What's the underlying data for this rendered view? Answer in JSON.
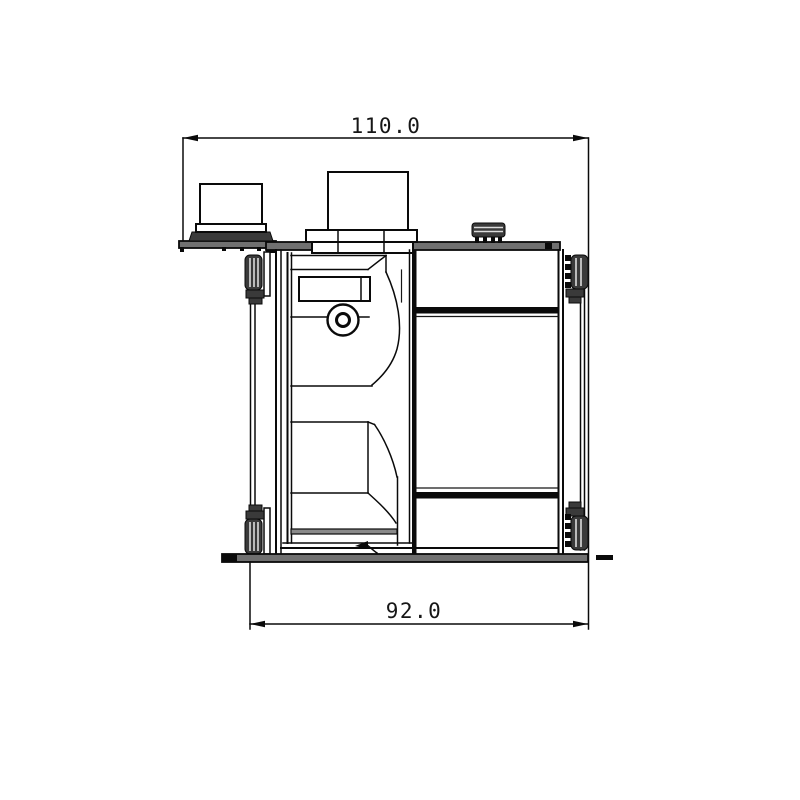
{
  "drawing": {
    "dimensions": {
      "top": {
        "label": "110.0",
        "value": 110.0
      },
      "bottom": {
        "label": "92.0",
        "value": 92.0
      }
    },
    "colors": {
      "line": "#0a0a0a",
      "plate_fill": "#707070",
      "clip_fill": "#3a3a3a",
      "background": "#ffffff"
    }
  }
}
